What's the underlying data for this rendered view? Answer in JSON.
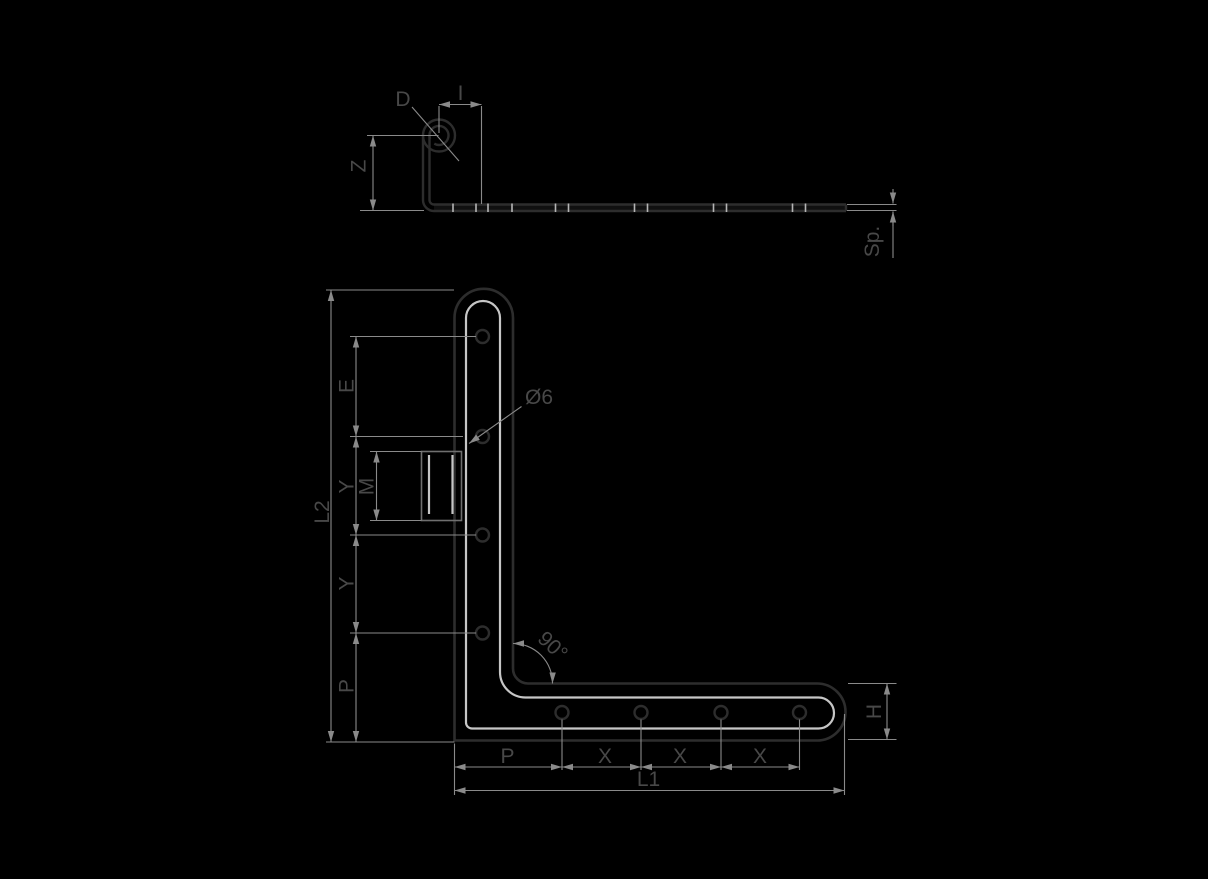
{
  "colors": {
    "background": "#000000",
    "part_outline": "#2d2d2d",
    "edge_highlight": "#c6c6c6",
    "dimension_lines": "#8a8a8a",
    "label_text": "#484848",
    "tick_marks": "#b5b5b5"
  },
  "side_view": {
    "curl_label": "D",
    "offset_label": "I",
    "height_label": "Z",
    "thickness_label": "Sp."
  },
  "front_view": {
    "vertical_leg_length_label": "L2",
    "edge_distance_label": "E",
    "hole_pitch_label_1": "Y",
    "thread_label": "M",
    "hole_pitch_label_2": "Y",
    "side_edge_distance_label": "P",
    "hole_diameter_label": "Ø6",
    "bend_angle_label": "90°",
    "bottom_edge_distance_label": "P",
    "bottom_pitch_label_1": "X",
    "bottom_pitch_label_2": "X",
    "bottom_pitch_label_3": "X",
    "horizontal_leg_length_label": "L1",
    "width_label": "H"
  }
}
